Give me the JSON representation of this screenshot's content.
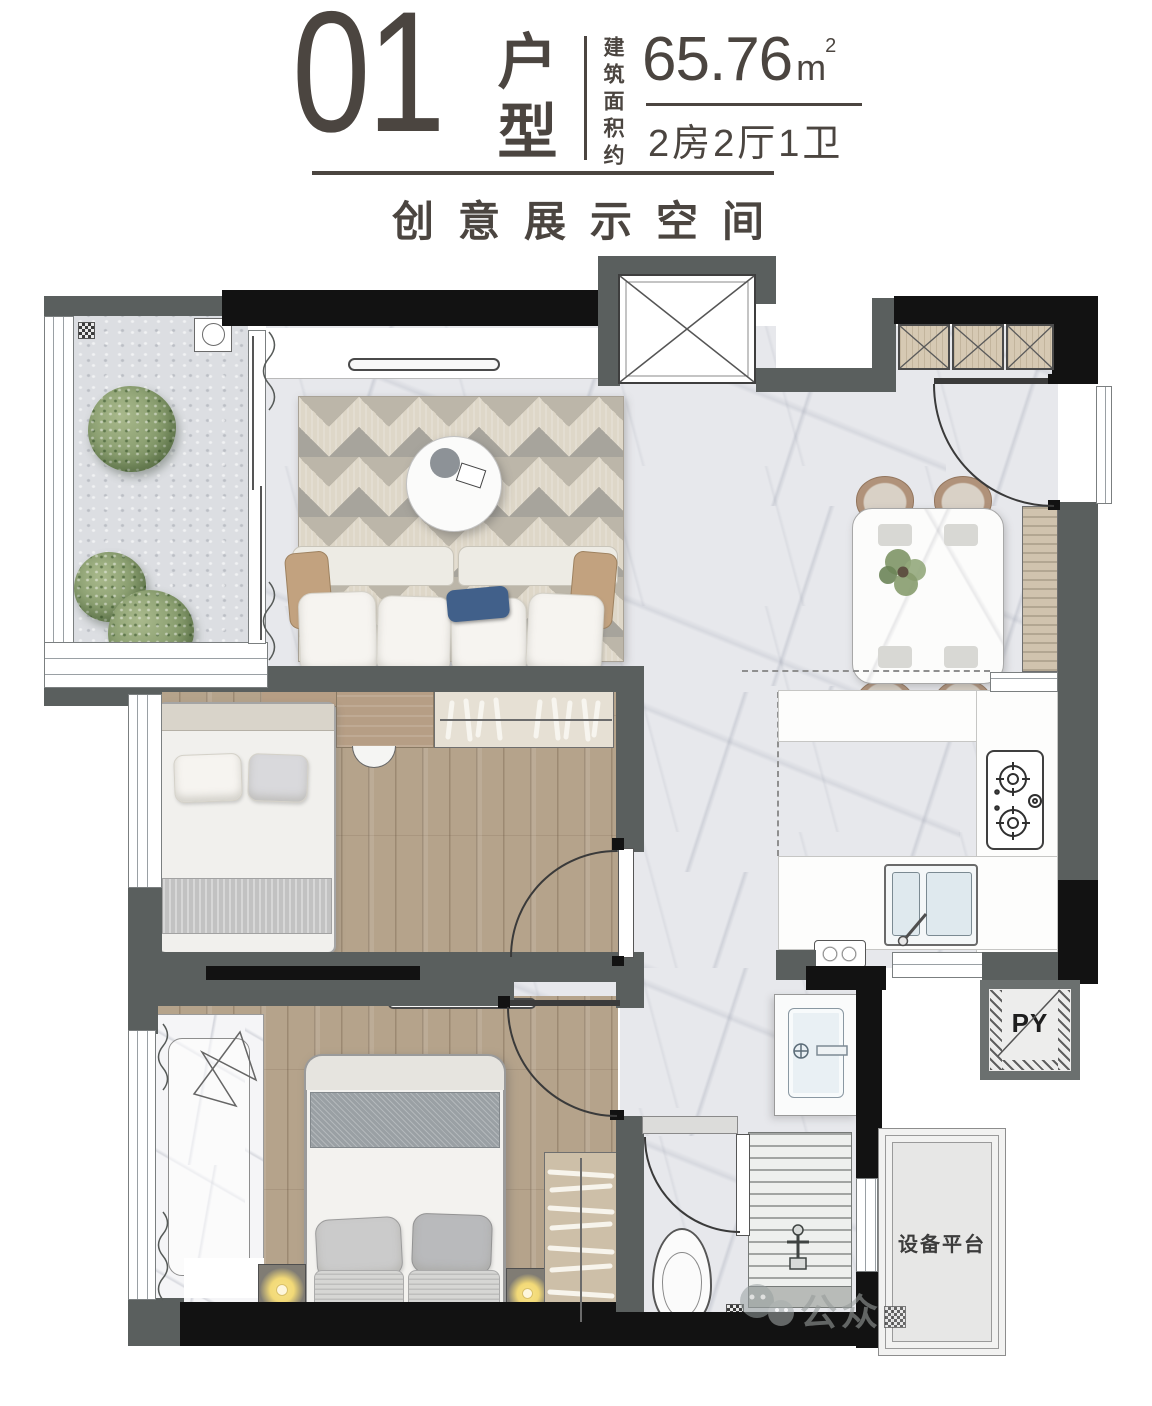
{
  "header": {
    "unit_number": "01",
    "unit_label": "户型",
    "area_prefix": "建筑面积约",
    "area_value": "65.76",
    "area_unit": "m",
    "area_sup": "2",
    "rooms_spec": "2房2厅1卫",
    "subtitle": "创意展示空间"
  },
  "plan": {
    "shaft_label": "PY",
    "equipment_label": "设备平台",
    "watermark_text": "公众"
  },
  "colors": {
    "ink": "#4b4540",
    "wall_gray": "#5a5f5e",
    "wall_black": "#121212",
    "wood_floor": "#b5a38b",
    "marble_floor": "#e7e8ec",
    "cabinet_tan": "#d6c9b3",
    "lamp_yellow": "#f2d977",
    "plant_green": "#869b6d",
    "navy_pillow": "#41608a"
  }
}
